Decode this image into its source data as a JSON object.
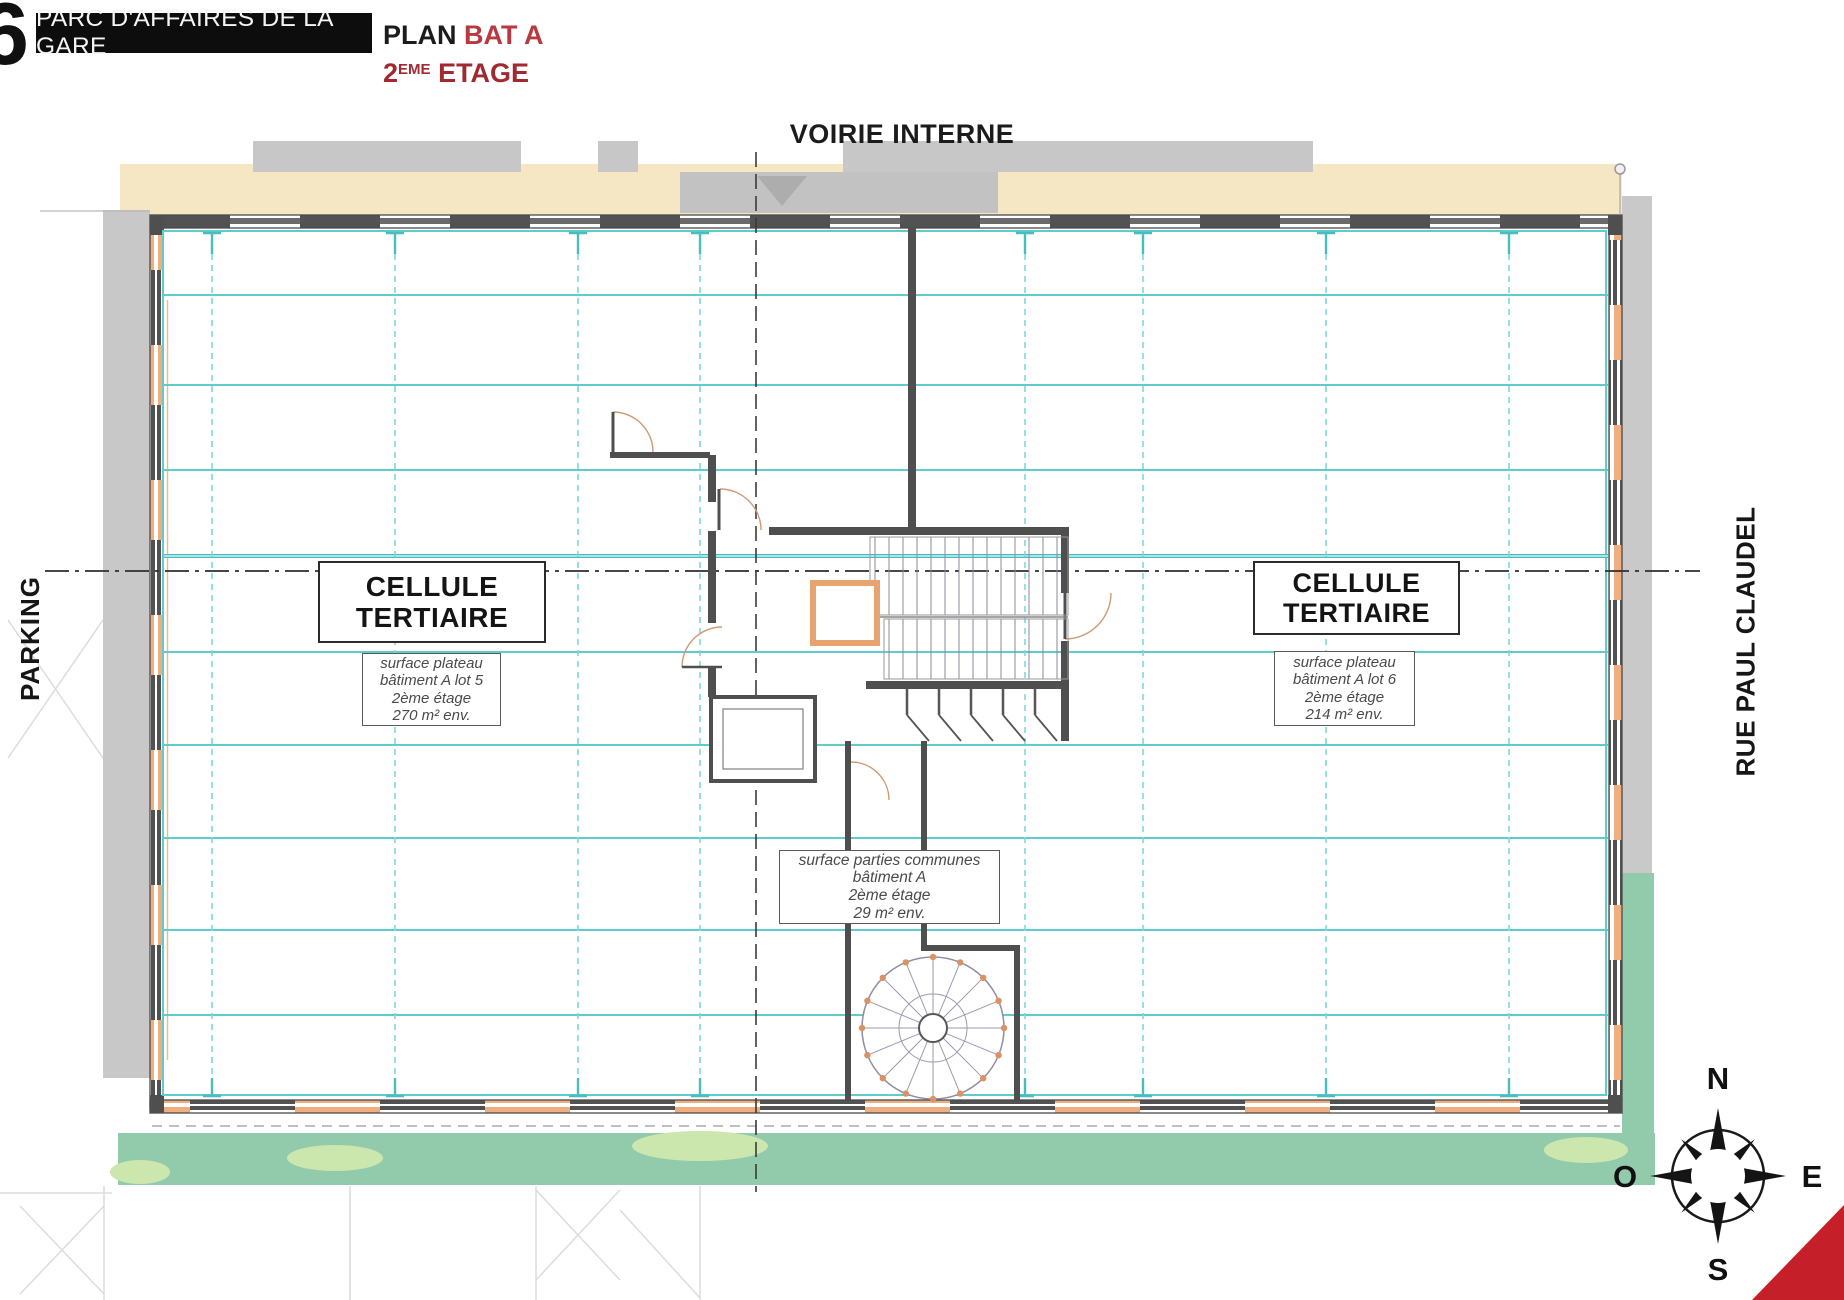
{
  "header": {
    "page_number": "6",
    "banner_title": "PARC D'AFFAIRES DE LA GARE",
    "plan_label": "PLAN",
    "plan_value": "BAT A",
    "floor_number": "2",
    "floor_sup": "EME",
    "floor_word": "ETAGE"
  },
  "streets": {
    "top": "VOIRIE INTERNE",
    "left": "PARKING",
    "right": "RUE PAUL CLAUDEL"
  },
  "cells": {
    "left": {
      "title_line1": "CELLULE",
      "title_line2": "TERTIAIRE",
      "detail_line1": "surface plateau",
      "detail_line2": "bâtiment A lot 5",
      "detail_line3": "2ème étage",
      "detail_line4": "270 m² env."
    },
    "right": {
      "title_line1": "CELLULE",
      "title_line2": "TERTIAIRE",
      "detail_line1": "surface plateau",
      "detail_line2": "bâtiment A lot 6",
      "detail_line3": "2ème étage",
      "detail_line4": "214 m² env."
    },
    "common": {
      "detail_line1": "surface parties communes",
      "detail_line2": "bâtiment A",
      "detail_line3": "2ème étage",
      "detail_line4": "29 m² env."
    }
  },
  "compass": {
    "north": "N",
    "south": "S",
    "east": "E",
    "west": "O"
  },
  "colors": {
    "accent_red": "#b8393f",
    "floor_red": "#a12a30",
    "banner_black": "#0d0d0d",
    "teal_line": "#5fcccc",
    "wall_gray": "#4f4f4f",
    "window_orange": "#eeae7e",
    "road_beige": "#f6e7c4",
    "green_band": "#92cbac",
    "green_light": "#cbe7ae",
    "area_gray": "#c8c8c8",
    "corner_red": "#c5202a"
  }
}
